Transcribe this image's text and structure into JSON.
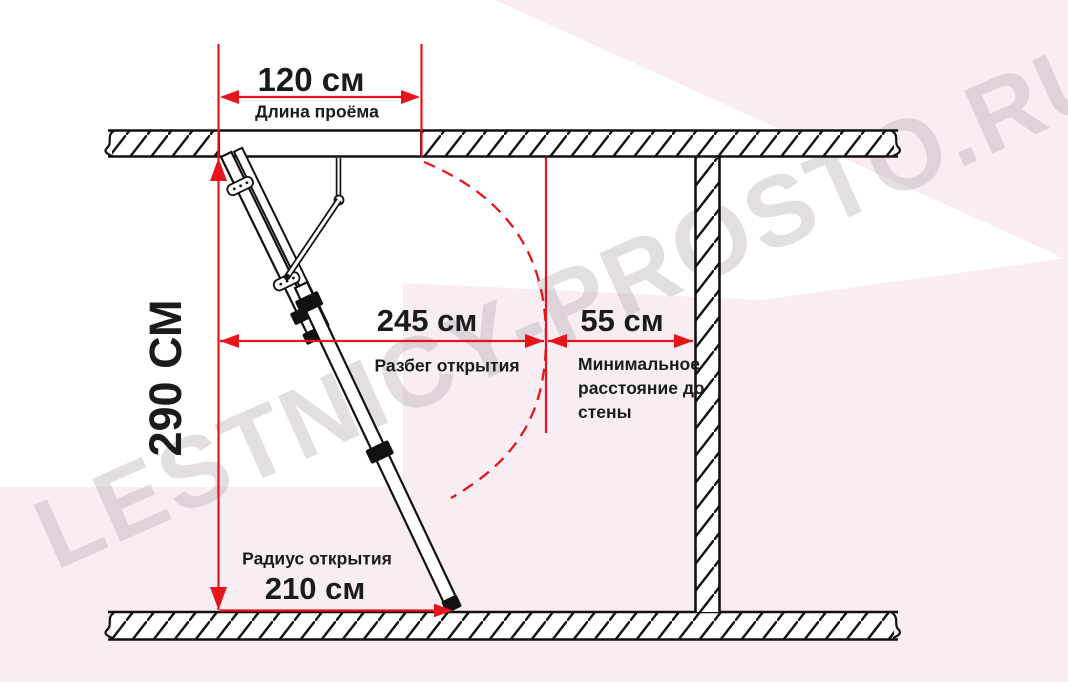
{
  "watermark": {
    "text": "LESTNICY-PROSTO.RU"
  },
  "colors": {
    "dimension_red": "#e8141c",
    "text": "#1b1b1b",
    "background_pink": "#f7edf3",
    "watermark_gray": "#bab0ba",
    "structure_black": "#111111"
  },
  "dimensions": {
    "opening_length": {
      "value": "120 см",
      "label": "Длина проёма"
    },
    "room_height": {
      "value": "290 СМ"
    },
    "opening_run": {
      "value": "245 см",
      "label": "Разбег открытия"
    },
    "min_wall_distance": {
      "value": "55 см",
      "label": "Минимальное расстояние до стены"
    },
    "opening_radius": {
      "value": "210 см",
      "label": "Радиус открытия"
    }
  }
}
